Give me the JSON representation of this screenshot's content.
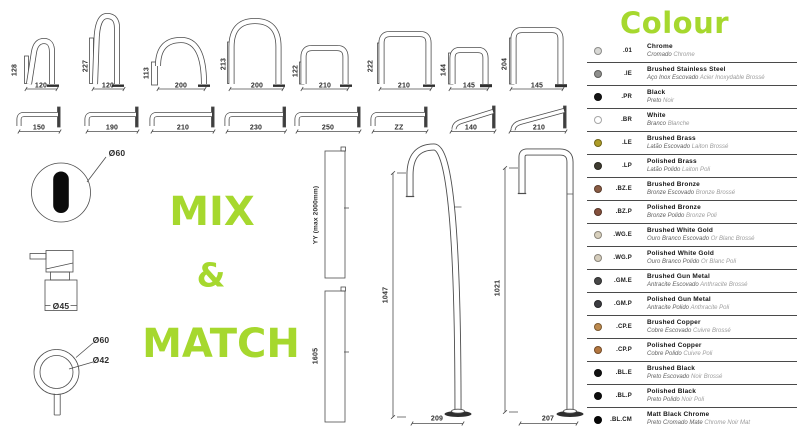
{
  "colors": {
    "accent": "#a6d82e",
    "line": "#4d4d4d"
  },
  "hero": {
    "line1": "MIX",
    "line2": "&",
    "line3": "MATCH"
  },
  "top_spouts": [
    {
      "height": "128",
      "width": "120"
    },
    {
      "height": "227",
      "width": "120"
    },
    {
      "height": "113",
      "width": "200"
    },
    {
      "height": "213",
      "width": "200"
    },
    {
      "height": "122",
      "width": "210"
    },
    {
      "height": "222",
      "width": "210"
    },
    {
      "height": "144",
      "width": "145"
    },
    {
      "height": "204",
      "width": "145"
    }
  ],
  "wall_spouts": [
    "150",
    "190",
    "210",
    "230",
    "250",
    "ZZ",
    "140",
    "210"
  ],
  "risers": [
    {
      "label": "YY (max 2000mm)"
    },
    {
      "label": "1605"
    }
  ],
  "freestanding": [
    {
      "height": "1047",
      "width": "209"
    },
    {
      "height": "1021",
      "width": "207"
    }
  ],
  "parts": {
    "sensor_diameter": "Ø60",
    "mixer_diameter": "Ø45",
    "handle_outer_diameter": "Ø60",
    "handle_inner_diameter": "Ø42"
  },
  "colour_legend": {
    "title": "Colour",
    "rows": [
      {
        "code": ".01",
        "name": "Chrome",
        "pt": "Cromado",
        "fr": "Chrome",
        "swatch": "#d8d8d5"
      },
      {
        "code": ".IE",
        "name": "Brushed Stainless Steel",
        "pt": "Aço Inox Escovado",
        "fr": "Acier Inoxydable Brossé",
        "swatch": "#8f8f8d"
      },
      {
        "code": ".PR",
        "name": "Black",
        "pt": "Preto",
        "fr": "Noir",
        "swatch": "#151515"
      },
      {
        "code": ".BR",
        "name": "White",
        "pt": "Branco",
        "fr": "Blanche",
        "swatch": "#ffffff"
      },
      {
        "code": ".LE",
        "name": "Brushed Brass",
        "pt": "Latão Escovado",
        "fr": "Laiton Brossé",
        "swatch": "#ad9c27"
      },
      {
        "code": ".LP",
        "name": "Polished Brass",
        "pt": "Latão Polido",
        "fr": "Laiton Poli",
        "swatch": "#3f3c31"
      },
      {
        "code": ".BZ.E",
        "name": "Brushed Bronze",
        "pt": "Bronze Escovado",
        "fr": "Bronze Brossé",
        "swatch": "#8a5c44"
      },
      {
        "code": ".BZ.P",
        "name": "Polished Bronze",
        "pt": "Bronze Polido",
        "fr": "Bronze Poli",
        "swatch": "#84503c"
      },
      {
        "code": ".WG.E",
        "name": "Brushed White Gold",
        "pt": "Ouro Branco Escovado",
        "fr": "Or Blanc Brossé",
        "swatch": "#d8d0bd"
      },
      {
        "code": ".WG.P",
        "name": "Polished White Gold",
        "pt": "Ouro Branco Polido",
        "fr": "Or Blanc Poli",
        "swatch": "#d5cdbc"
      },
      {
        "code": ".GM.E",
        "name": "Brushed Gun Metal",
        "pt": "Antracite Escovado",
        "fr": "Anthracite Brossé",
        "swatch": "#474747"
      },
      {
        "code": ".GM.P",
        "name": "Polished Gun Metal",
        "pt": "Antracite Polido",
        "fr": "Anthracite Poli",
        "swatch": "#3c3c40"
      },
      {
        "code": ".CP.E",
        "name": "Brushed Copper",
        "pt": "Cobre Escovado",
        "fr": "Cuivre Brossé",
        "swatch": "#bd8a4e"
      },
      {
        "code": ".CP.P",
        "name": "Polished Copper",
        "pt": "Cobre Polido",
        "fr": "Cuivre Poli",
        "swatch": "#b3763f"
      },
      {
        "code": ".BL.E",
        "name": "Brushed Black",
        "pt": "Preto Escovado",
        "fr": "Noir Brossé",
        "swatch": "#111111"
      },
      {
        "code": ".BL.P",
        "name": "Polished Black",
        "pt": "Preto Polido",
        "fr": "Noir Poli",
        "swatch": "#0e0e0e"
      },
      {
        "code": ".BL.CM",
        "name": "Matt Black Chrome",
        "pt": "Preto Cromado Mate",
        "fr": "Chrome Noir Mat",
        "swatch": "#060606"
      }
    ]
  }
}
